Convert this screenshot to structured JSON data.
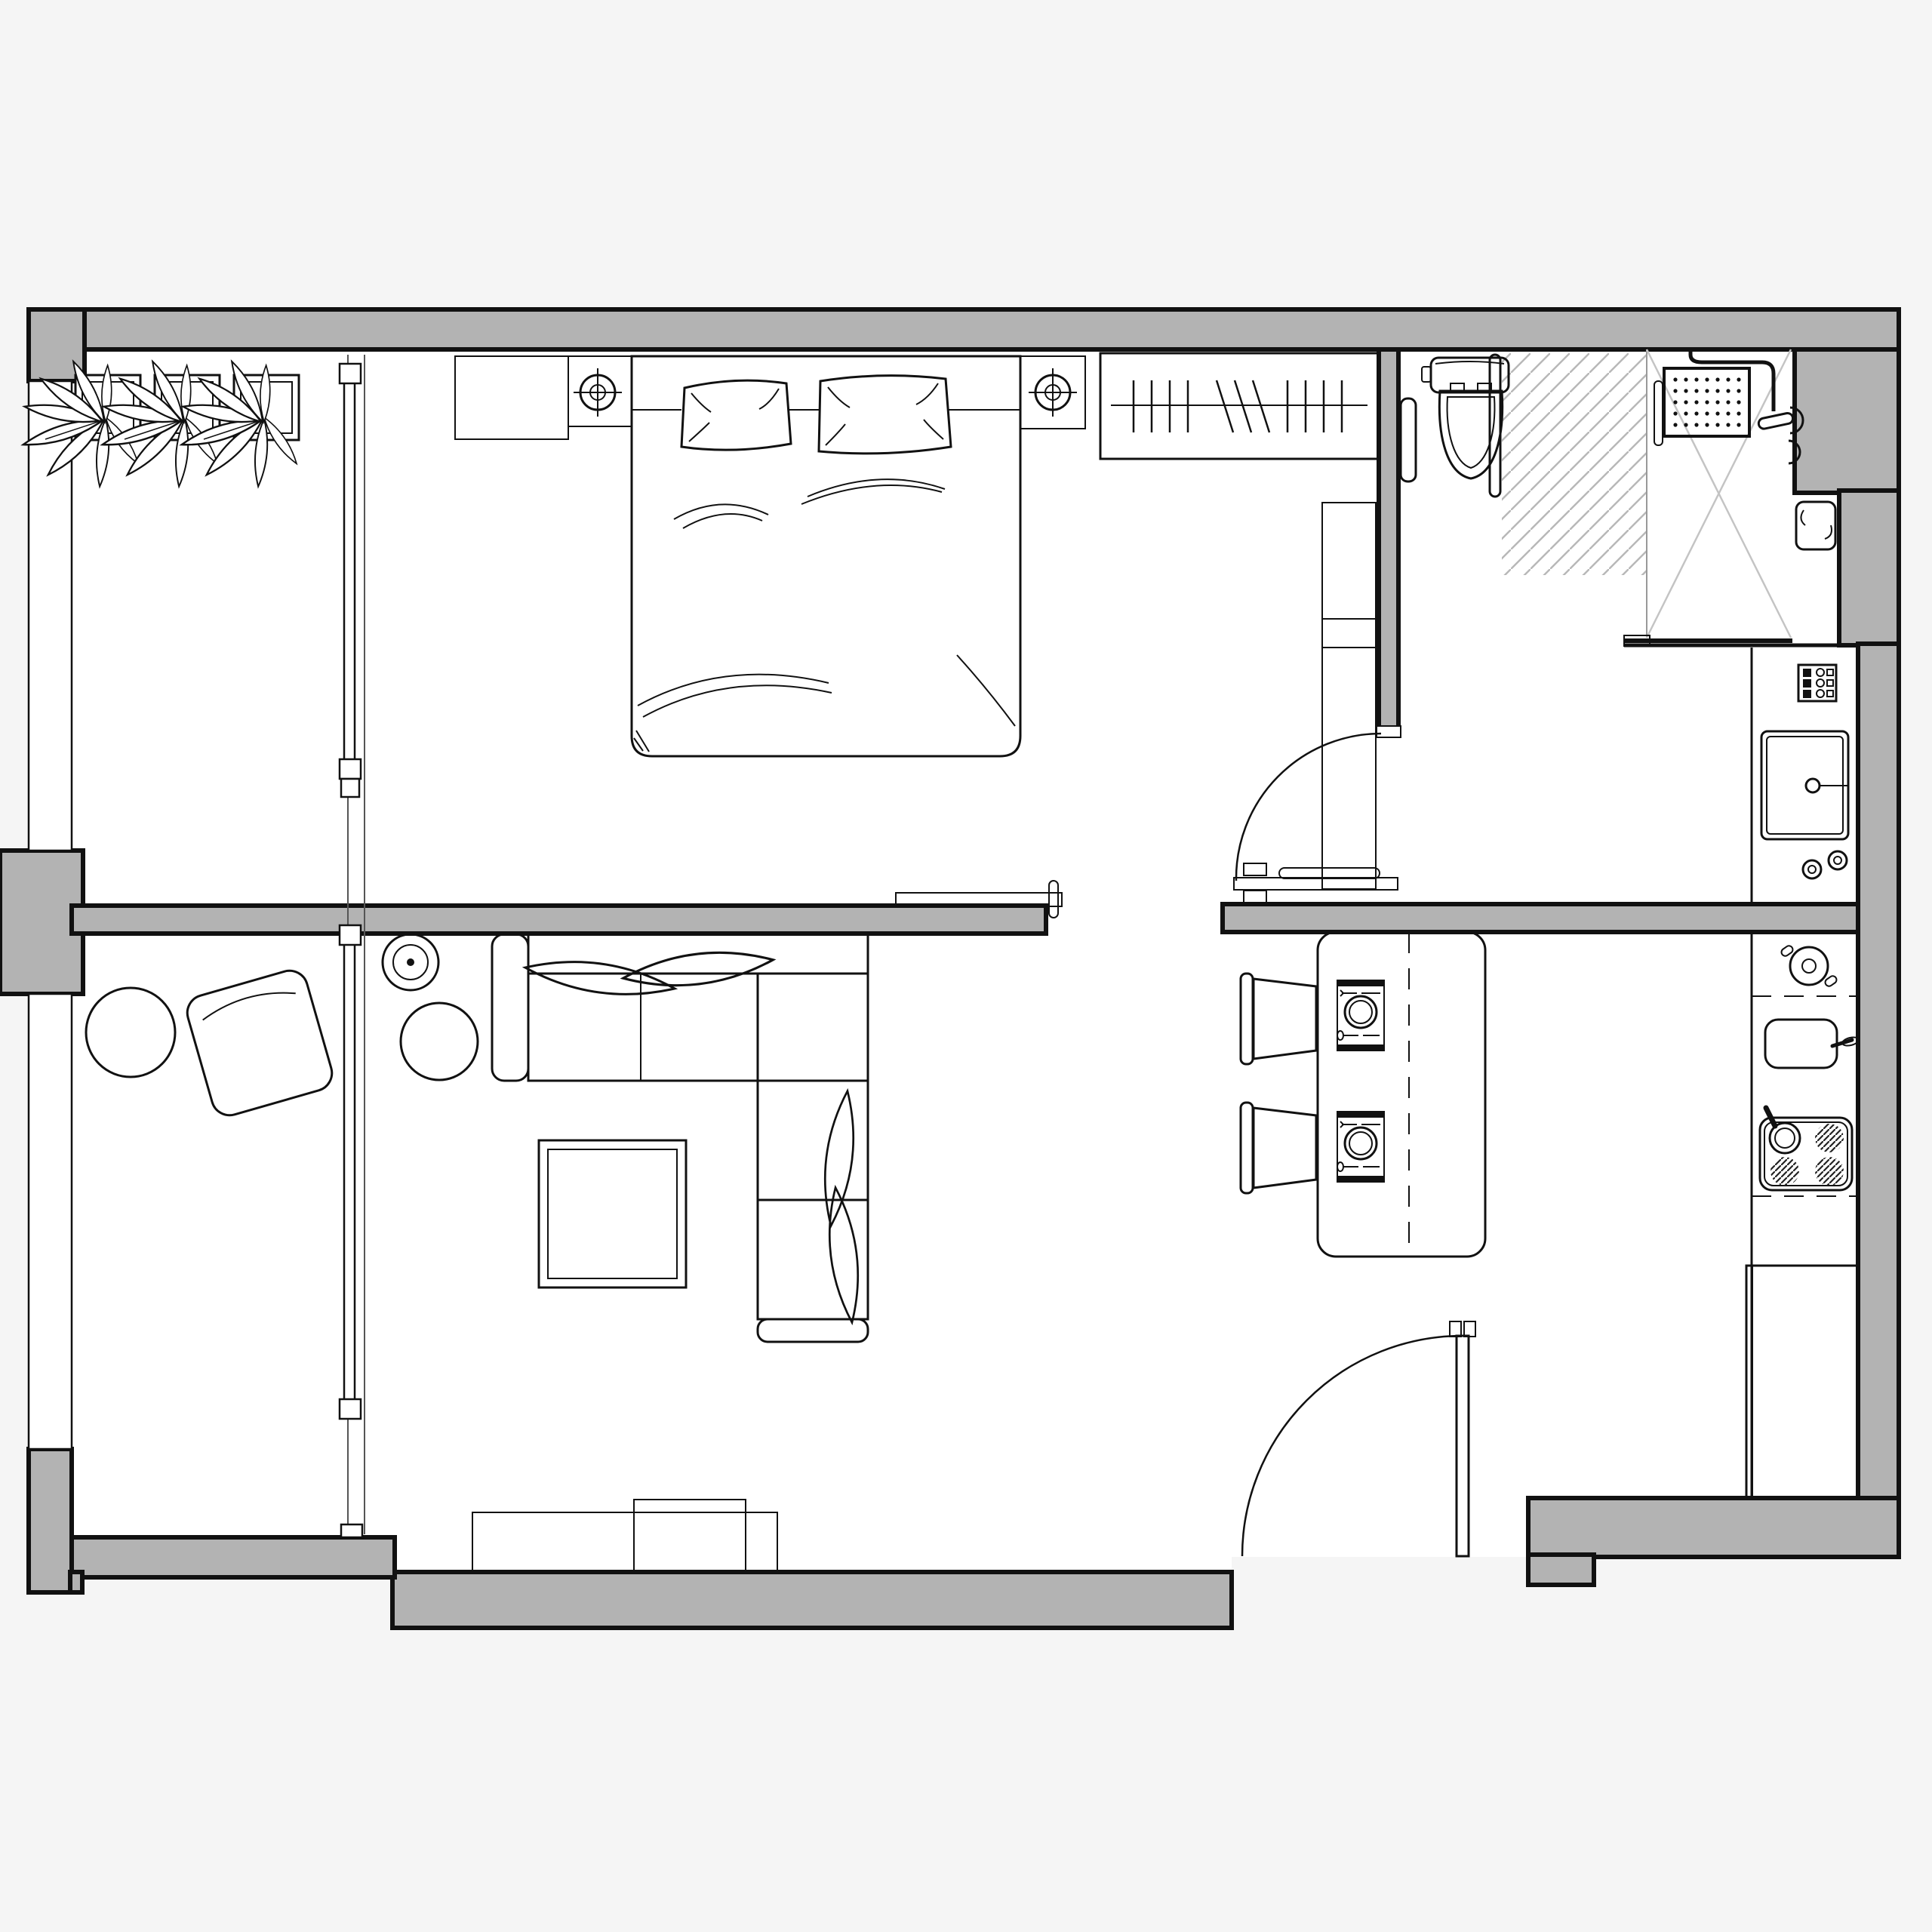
{
  "meta": {
    "type": "architectural-floor-plan",
    "view": "top-down",
    "visible_text": "none"
  },
  "colors": {
    "page_bg": "#f5f5f5",
    "floor": "#ffffff",
    "wall_fill": "#b3b3b3",
    "line": "#111111",
    "hatch": "#b8b8b8",
    "glass": "#c4c4c4"
  },
  "plan": {
    "rooms": [
      {
        "name": "balcony-bay",
        "items": [
          "potted-plant",
          "potted-plant",
          "potted-plant",
          "glazed-partition-with-sliding-panels"
        ]
      },
      {
        "name": "bedroom",
        "items": [
          "dresser",
          "nightstand-with-ceiling-lamp-symbol",
          "double-bed-with-two-pillows",
          "nightstand-with-ceiling-lamp-symbol",
          "wardrobe-with-clothes-hangers",
          "tall-cabinet",
          "pocket-sliding-door"
        ]
      },
      {
        "name": "bathroom",
        "items": [
          "toilet",
          "towel-radiator",
          "grab-bar",
          "shower-head-with-drain-grid",
          "shower-tray-with-glass",
          "hatched-wet-floor-zone",
          "towel-in-niche"
        ]
      },
      {
        "name": "hallway-dining",
        "items": [
          "dining-table",
          "dining-chair",
          "dining-chair",
          "place-setting",
          "place-setting",
          "sliding-door-track",
          "bedroom-swing-door"
        ]
      },
      {
        "name": "kitchen",
        "items": [
          "washing-machine-with-controls",
          "cooking-pot",
          "kitchen-sink-with-faucet",
          "cooktop-4-burner-with-pan",
          "kitchen-counter",
          "tall-fridge-cabinet"
        ]
      },
      {
        "name": "living-room",
        "items": [
          "round-side-table",
          "rotated-armchair",
          "floor-lamp",
          "side-table",
          "corner-sofa",
          "sofa-pillows",
          "coffee-table",
          "tv-sideboard"
        ]
      }
    ],
    "doors": [
      {
        "name": "entrance-swing-door",
        "wall": "bottom"
      },
      {
        "name": "bedroom-swing-door",
        "wall": "middle"
      },
      {
        "name": "pocket-sliding-door-left",
        "wall": "middle"
      },
      {
        "name": "pocket-sliding-door-right",
        "wall": "middle"
      }
    ],
    "windows": [
      {
        "name": "left-window-upper"
      },
      {
        "name": "left-window-lower"
      }
    ]
  }
}
